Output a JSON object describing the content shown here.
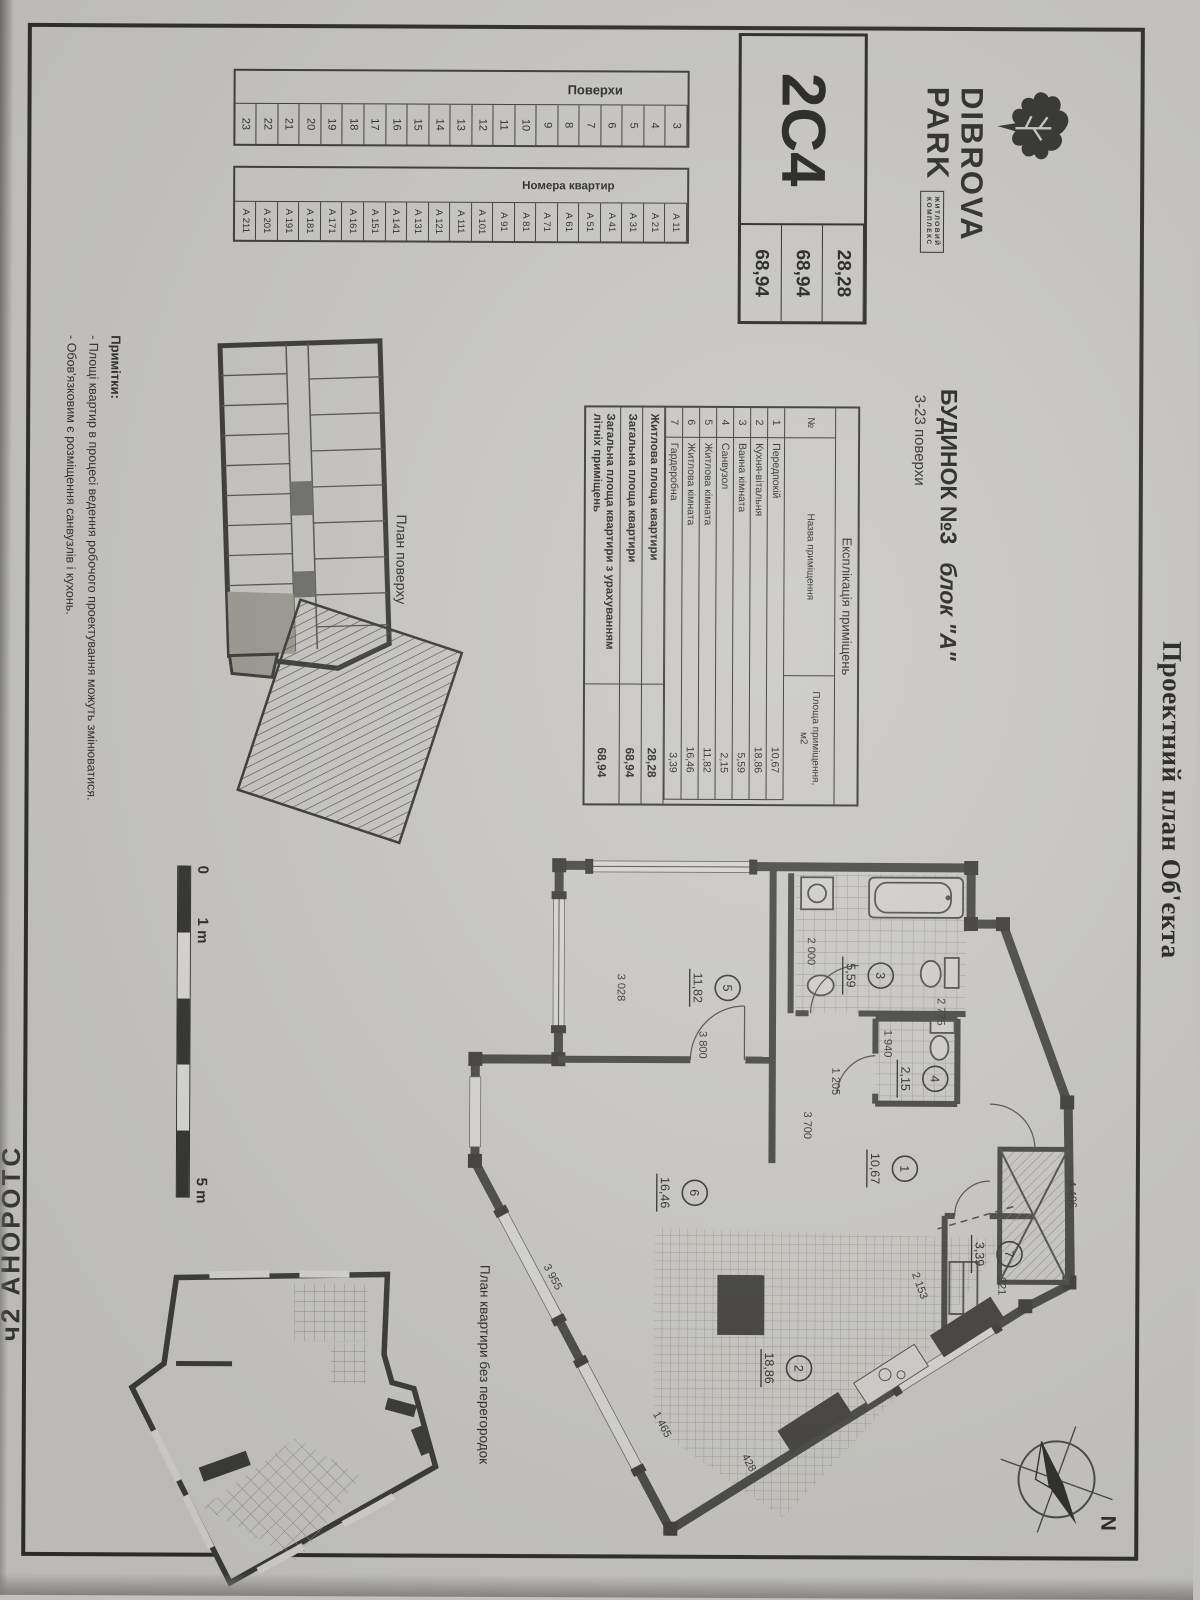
{
  "page": {
    "title": "Проектний план Об'єкта",
    "side_text": "СТОРОНА 2ч",
    "compass_label": "N"
  },
  "logo": {
    "name_line1": "DIBROVA",
    "name_line2": "PARK",
    "tagline_line1": "ЖИТЛОВИЙ",
    "tagline_line2": "КОМПЛЕКС"
  },
  "unit_card": {
    "code": "2С4",
    "values": [
      "28,28",
      "68,94",
      "68,94"
    ]
  },
  "building": {
    "title": "БУДИНОК №3",
    "block": "блок \"А\"",
    "floors": "3-23 поверхи"
  },
  "floors_table": {
    "header": "Поверхи",
    "cells": [
      "3",
      "4",
      "5",
      "6",
      "7",
      "8",
      "9",
      "10",
      "11",
      "12",
      "13",
      "14",
      "15",
      "16",
      "17",
      "18",
      "19",
      "20",
      "21",
      "22",
      "23"
    ]
  },
  "apartments_table": {
    "header": "Номера квартир",
    "cells": [
      "А 11",
      "А 21",
      "А 31",
      "А 41",
      "А 51",
      "А 61",
      "А 71",
      "А 81",
      "А 91",
      "А 101",
      "А 111",
      "А 121",
      "А 131",
      "А 141",
      "А 151",
      "А 161",
      "А 171",
      "А 181",
      "А 191",
      "А 201",
      "А 211"
    ]
  },
  "explication": {
    "title": "Експлікація приміщень",
    "columns": {
      "no": "№",
      "name": "Назва приміщення",
      "area": "Площа приміщення, м2"
    },
    "rows": [
      {
        "no": "1",
        "name": "Передпокій",
        "area": "10,67"
      },
      {
        "no": "2",
        "name": "Кухня-вітальня",
        "area": "18,86"
      },
      {
        "no": "3",
        "name": "Ванна кімната",
        "area": "5,59"
      },
      {
        "no": "4",
        "name": "Санвузол",
        "area": "2,15"
      },
      {
        "no": "5",
        "name": "Житлова кімната",
        "area": "11,82"
      },
      {
        "no": "6",
        "name": "Житлова кімната",
        "area": "16,46"
      },
      {
        "no": "7",
        "name": "Гардеробна",
        "area": "3,39"
      }
    ],
    "summary": [
      {
        "label": "Житлова площа квартири",
        "value": "28,28"
      },
      {
        "label": "Загальна площа квартири",
        "value": "68,94"
      },
      {
        "label": "Загальна площа квартири з урахуванням літніх приміщень",
        "value": "68,94"
      }
    ]
  },
  "floor_plan": {
    "caption": "План поверху"
  },
  "scale_bar": {
    "zero": "0",
    "one": "1 m",
    "five": "5 m"
  },
  "apartment_plan": {
    "caption": "План квартири без перегородок",
    "rooms": [
      {
        "no": "1",
        "area": "10,67"
      },
      {
        "no": "2",
        "area": "18,86"
      },
      {
        "no": "3",
        "area": "5,59"
      },
      {
        "no": "4",
        "area": "2,15"
      },
      {
        "no": "5",
        "area": "11,82"
      },
      {
        "no": "6",
        "area": "16,46"
      },
      {
        "no": "7",
        "area": "3,39"
      }
    ],
    "dimensions": {
      "room5_w": "3 800",
      "room5_h": "3 028",
      "bath_left": "2 000",
      "bath_w": "2 775",
      "wc_w": "1 940",
      "corridor": "1 205",
      "hall_h": "3 700",
      "balcony": "4 406",
      "room6_diag": "3 955",
      "room6_bottom": "1 465",
      "kitchen_corner": "428",
      "kitchen_top": "2 153",
      "wardrobe": "921"
    }
  },
  "notes": {
    "title": "Примітки:",
    "items": [
      "- Площі квартир в процесі ведення робочого проектування можуть змінюватися.",
      "- Обов'язковим є розміщення санвузлів і кухонь."
    ]
  }
}
